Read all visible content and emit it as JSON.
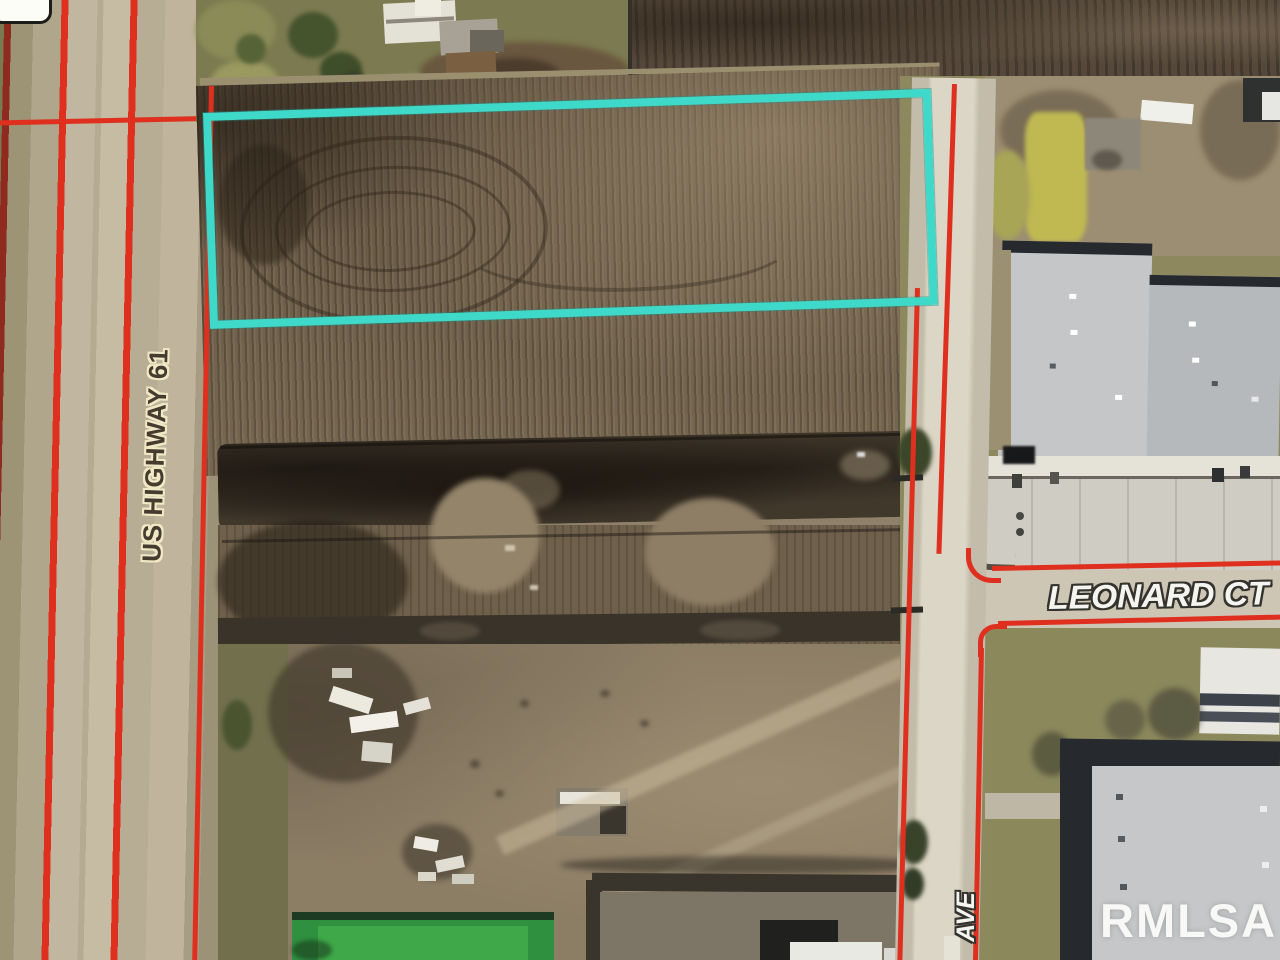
{
  "map": {
    "description": "aerial parcel map with highlighted lot",
    "labels": {
      "highway": "US HIGHWAY 61",
      "cross_street": "LEONARD CT",
      "avenue": "AVE"
    },
    "watermark": "RMLSA",
    "colors": {
      "parcel_highlight": "#3fd9ca",
      "parcel_boundary_red": "#df2f1f",
      "parcel_boundary_dark_red": "#8e2a1e",
      "lot_line_dark": "#33302a"
    }
  }
}
